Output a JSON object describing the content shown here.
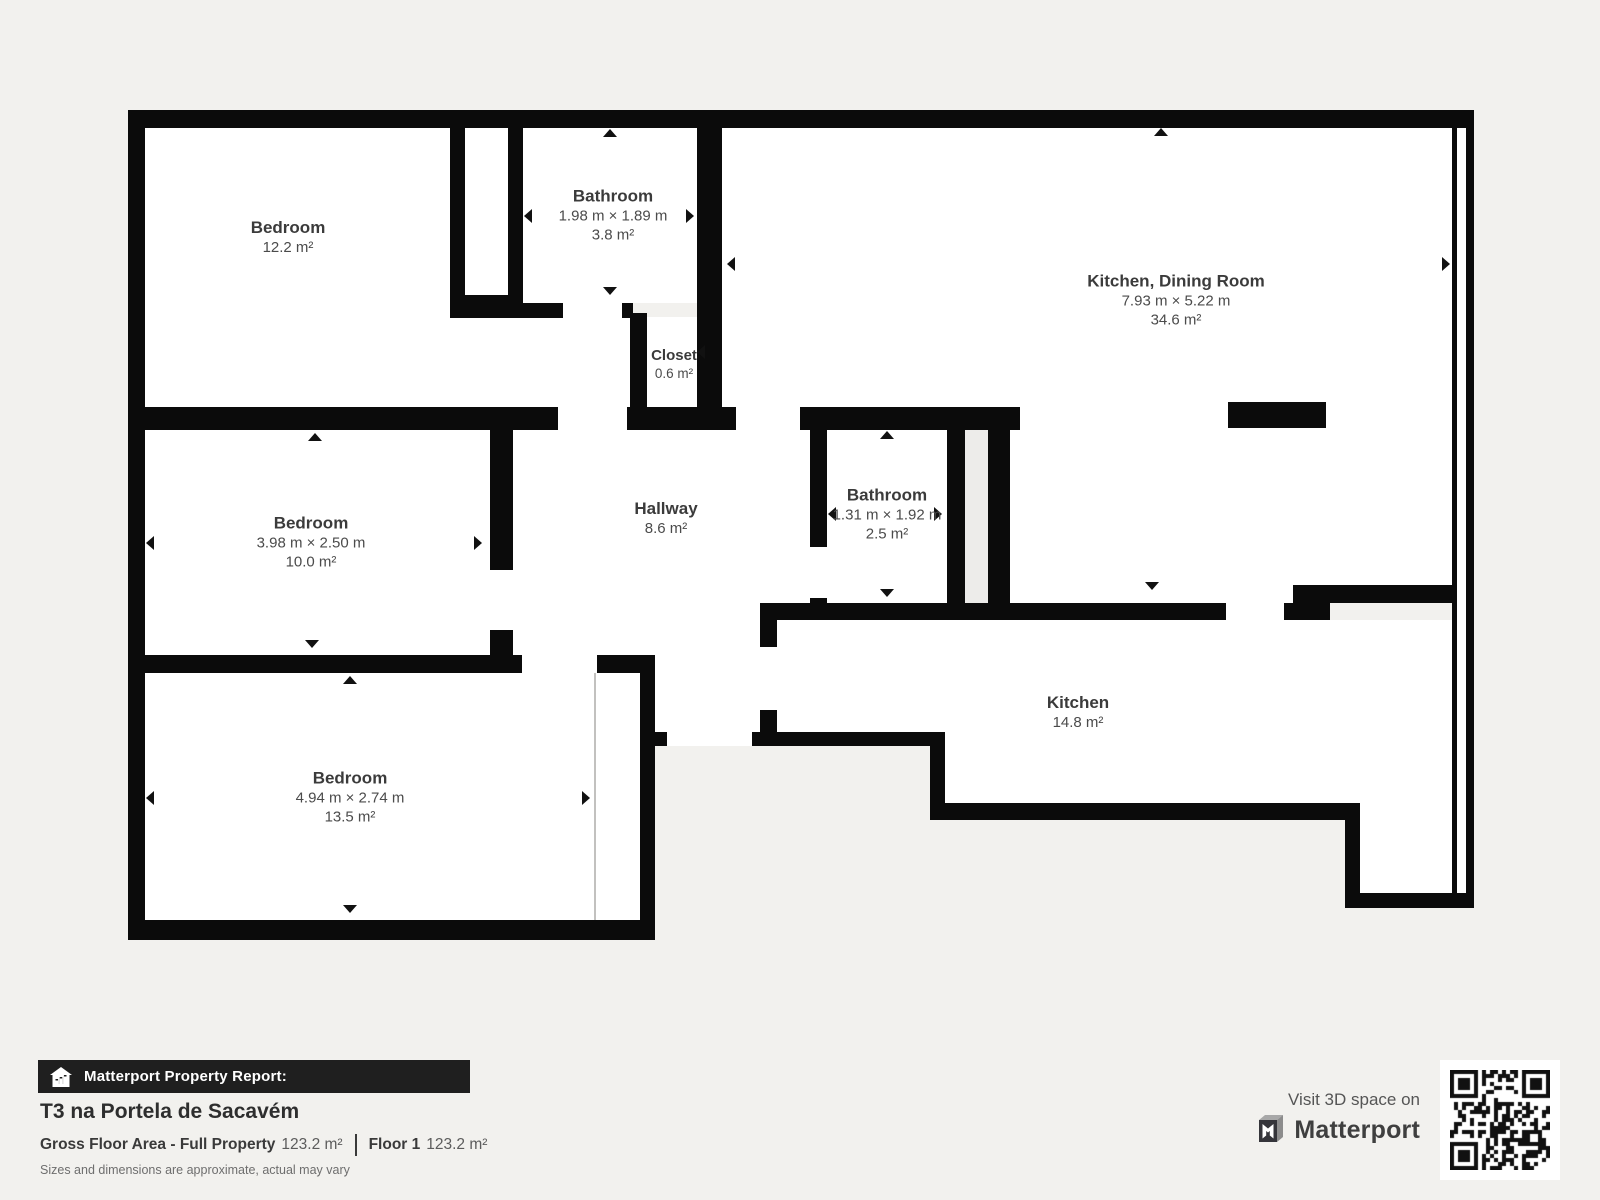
{
  "rooms": [
    {
      "name": "Bedroom",
      "area": "12.2 m²"
    },
    {
      "name": "Bathroom",
      "dimensions": "1.98 m × 1.89 m",
      "area": "3.8 m²"
    },
    {
      "name": "Kitchen, Dining Room",
      "dimensions": "7.93 m × 5.22 m",
      "area": "34.6 m²"
    },
    {
      "name": "Closet",
      "area": "0.6 m²"
    },
    {
      "name": "Bedroom",
      "dimensions": "3.98 m × 2.50 m",
      "area": "10.0 m²"
    },
    {
      "name": "Hallway",
      "area": "8.6 m²"
    },
    {
      "name": "Bathroom",
      "dimensions": "1.31 m × 1.92 m",
      "area": "2.5 m²"
    },
    {
      "name": "Kitchen",
      "area": "14.8 m²"
    },
    {
      "name": "Bedroom",
      "dimensions": "4.94 m × 2.74 m",
      "area": "13.5 m²"
    }
  ],
  "footer": {
    "report_label": "Matterport Property Report:",
    "property_title": "T3 na Portela de Sacavém",
    "gross_floor_area_label": "Gross Floor Area - Full Property",
    "gross_floor_area_value": "123.2 m²",
    "floor_label": "Floor 1",
    "floor_value": "123.2 m²",
    "disclaimer": "Sizes and dimensions are approximate, actual may vary"
  },
  "branding": {
    "visit_text": "Visit 3D space on",
    "brand_name": "Matterport"
  },
  "colors": {
    "background": "#f2f1ee",
    "wall": "#0b0b0b",
    "room_fill": "#ffffff",
    "report_bar": "#1f1f1f",
    "label_text": "#3b3b3b"
  }
}
